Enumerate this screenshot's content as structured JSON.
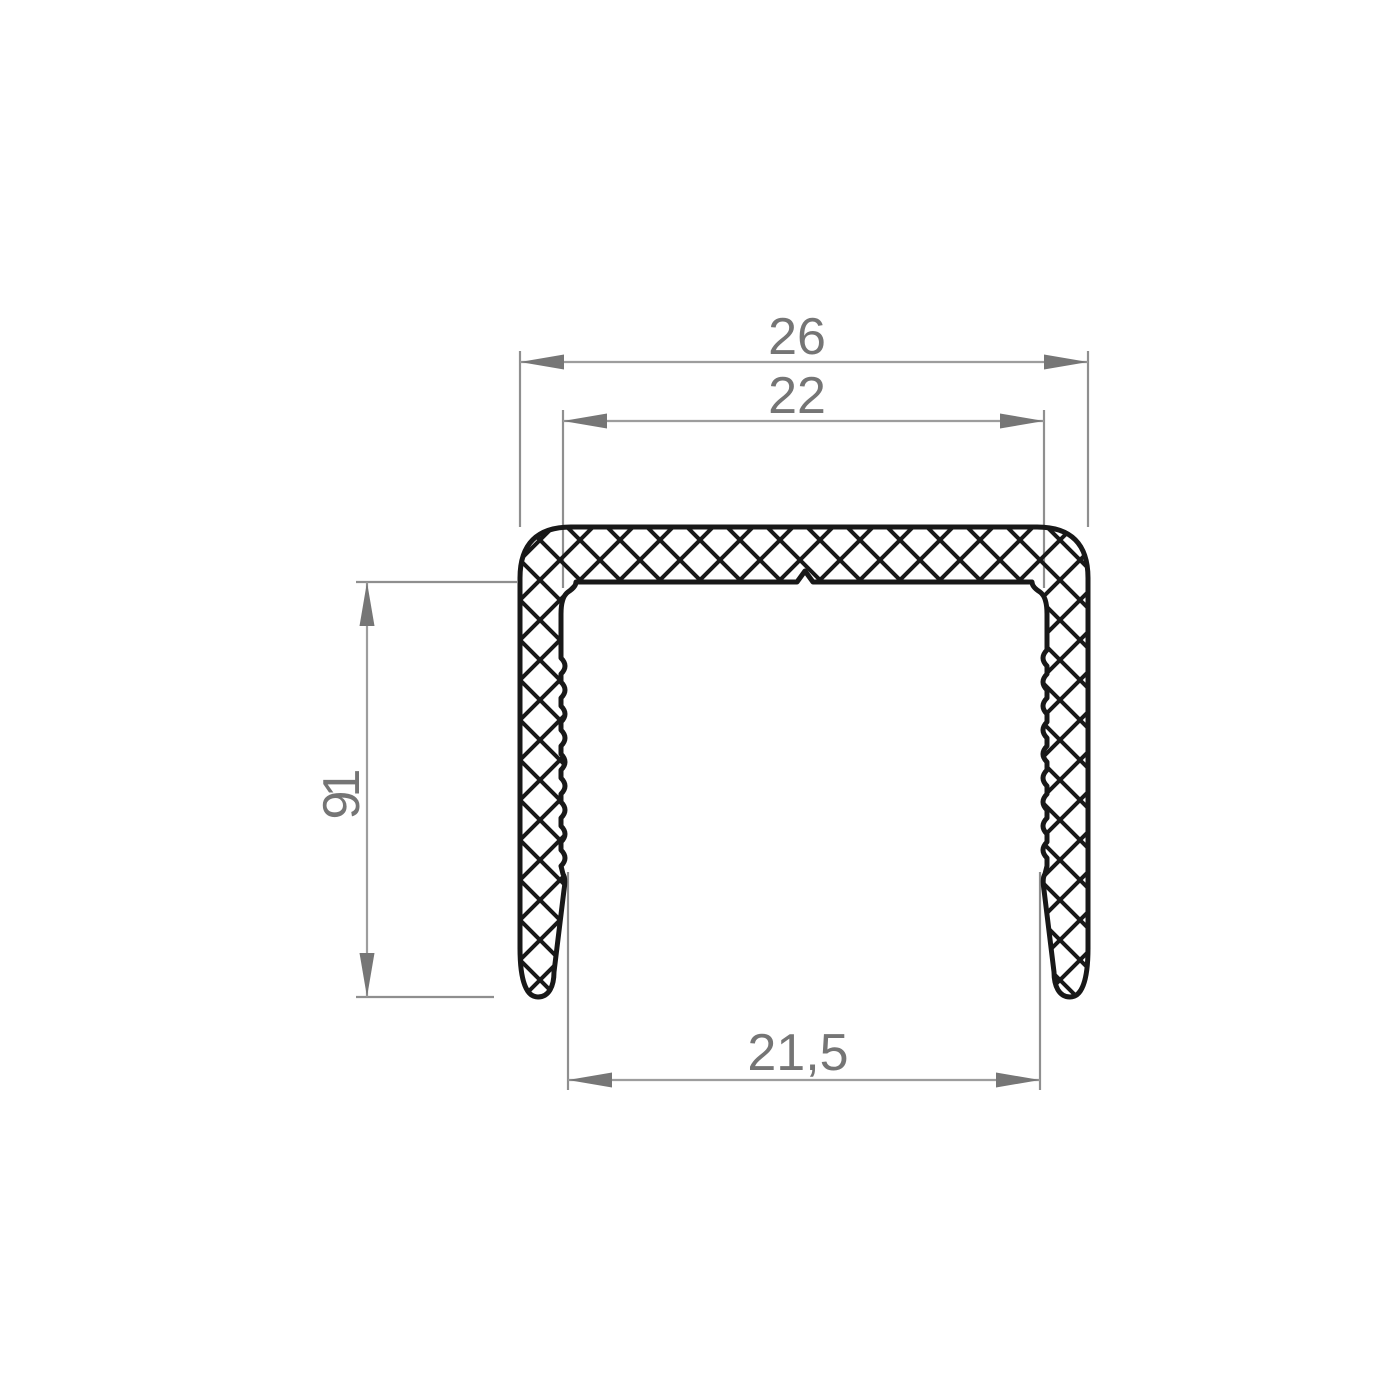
{
  "drawing": {
    "type": "profile-cross-section",
    "background_color": "#ffffff",
    "outline_color": "#181818",
    "hatch_color": "#181818",
    "dim_line_color": "#9d9d9d",
    "ext_line_color": "#8f8f8f",
    "arrow_color": "#767676",
    "dim_text_color": "#757575",
    "dimensions": {
      "outer_width": {
        "value": "26"
      },
      "inner_width": {
        "value": "22"
      },
      "leg_height": {
        "value": "19"
      },
      "bottom_width": {
        "value": "21,5"
      }
    }
  }
}
